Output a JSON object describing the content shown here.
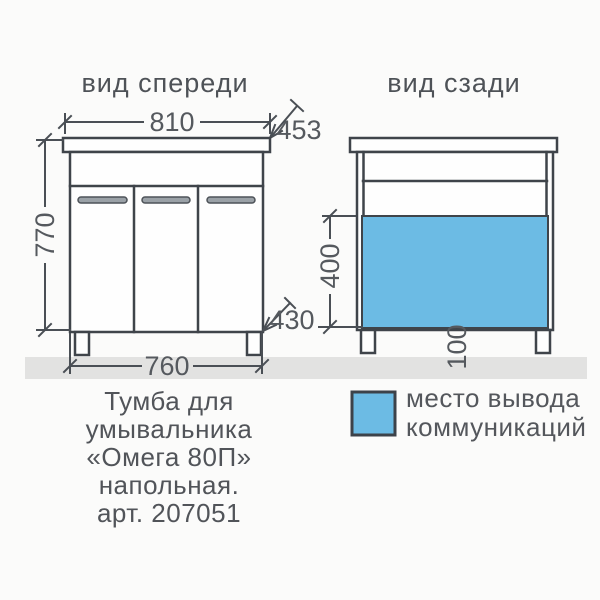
{
  "drawing": {
    "front_view": {
      "title": "вид спереди",
      "dim_top_width": "810",
      "dim_depth": "453",
      "dim_height": "770",
      "dim_body_depth": "430",
      "dim_bottom_width": "760"
    },
    "back_view": {
      "title": "вид сзади",
      "dim_zone_height": "400",
      "dim_zone_offset": "100"
    },
    "legend": {
      "swatch_color": "#6cbbe4",
      "label_line1": "место вывода",
      "label_line2": "коммуникаций"
    },
    "caption": {
      "line1": "Тумба для",
      "line2": "умывальника",
      "line3": "«Омега 80П»",
      "line4": "напольная.",
      "line5": "арт. 207051"
    },
    "colors": {
      "line": "#3f444a",
      "text": "#54575c",
      "accent_blue": "#6cbbe4",
      "floor": "#e2e2e1",
      "background": "#fbfbfa",
      "handle": "#9aa1a7"
    }
  }
}
